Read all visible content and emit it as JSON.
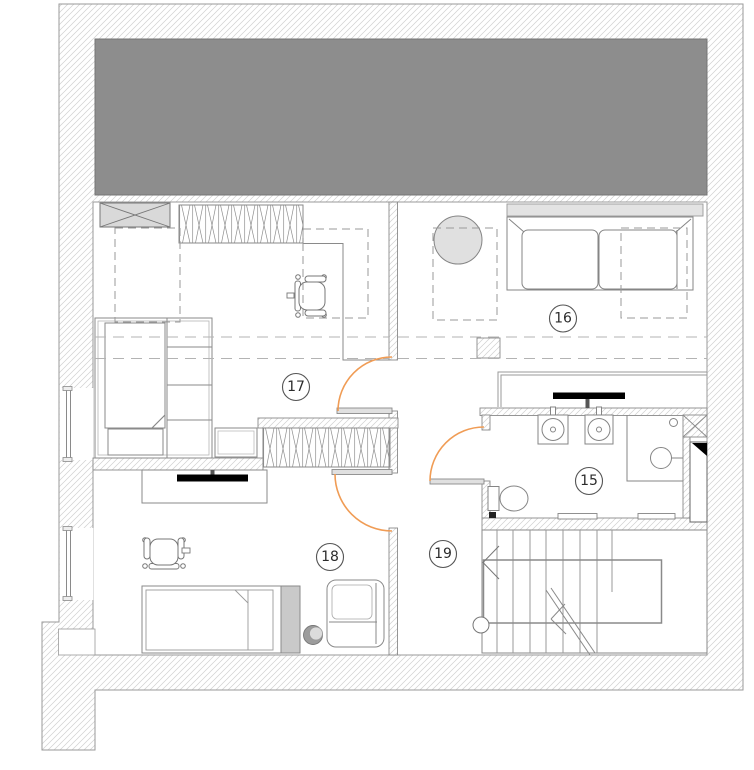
{
  "plan": {
    "type": "architectural-floor-plan",
    "rooms": [
      {
        "label": "15"
      },
      {
        "label": "16"
      },
      {
        "label": "17"
      },
      {
        "label": "18"
      },
      {
        "label": "19"
      }
    ],
    "colors": {
      "roof_gray": "#8d8d8d",
      "roof_border": "#757575",
      "door_arc": "#f09c55",
      "hatch_line": "#d0d0d0",
      "wall_line": "#9a9a9a",
      "furniture_line": "#858585",
      "tv_black": "#000000",
      "leaf_fill": "#e0e0e0",
      "shelf_gray": "#e3e3e3",
      "bed_gray": "#c9c9c9"
    }
  }
}
